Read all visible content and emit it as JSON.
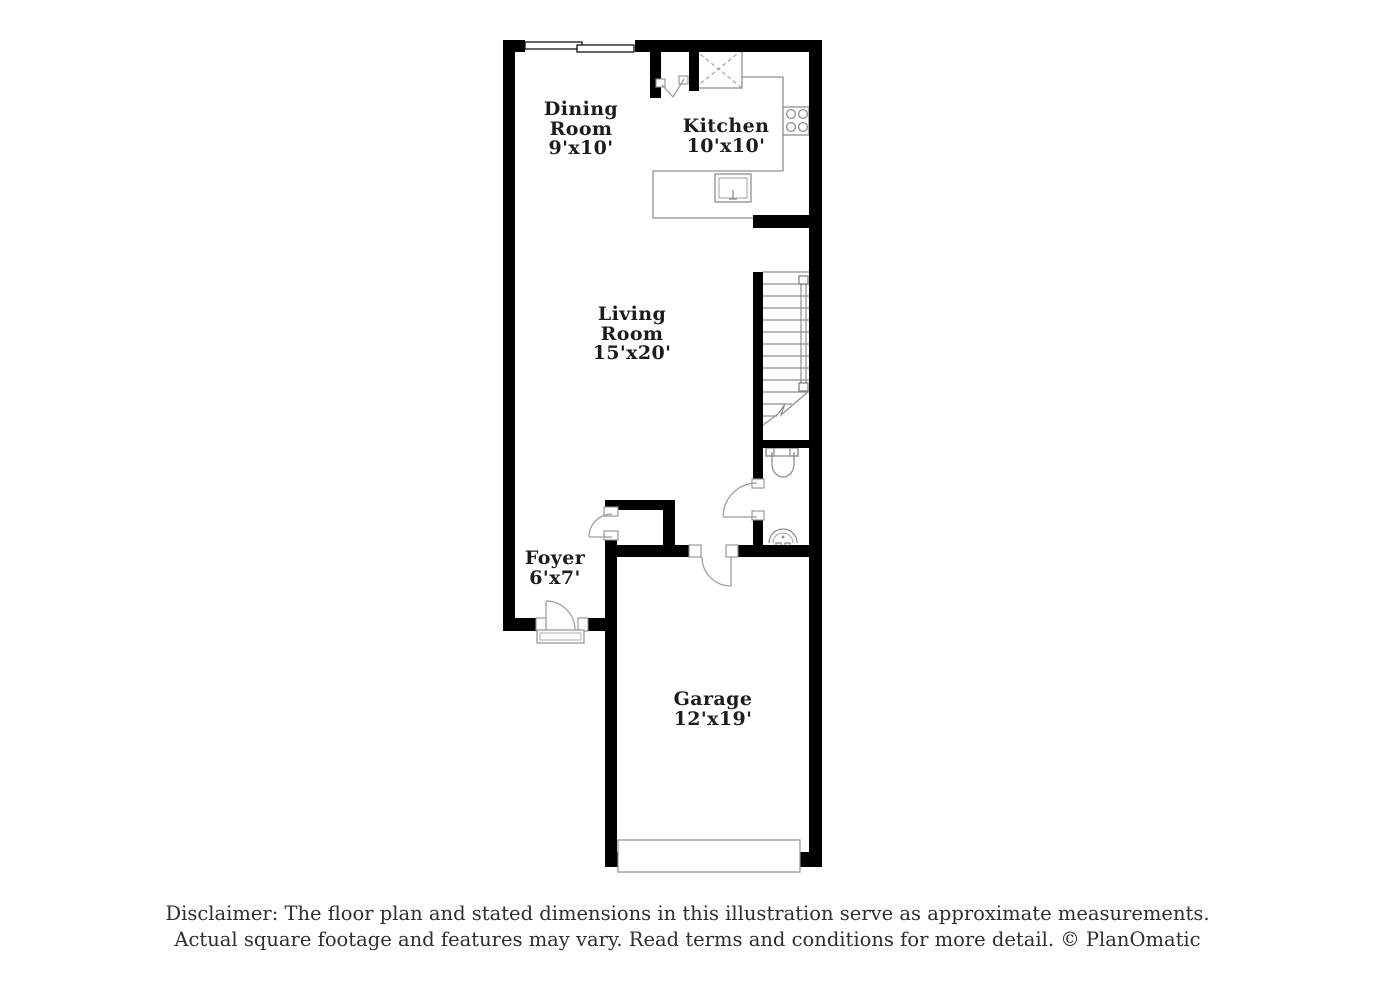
{
  "floorplan": {
    "rooms": {
      "dining": {
        "label": "Dining Room",
        "dims": "9'x10'"
      },
      "kitchen": {
        "label": "Kitchen",
        "dims": "10'x10'"
      },
      "living": {
        "label": "Living Room",
        "dims": "15'x20'"
      },
      "foyer": {
        "label": "Foyer",
        "dims": "6'x7'"
      },
      "garage": {
        "label": "Garage",
        "dims": "12'x19'"
      }
    },
    "fixtures": [
      "window",
      "refrigerator",
      "bifold-door",
      "stove",
      "kitchen-sink",
      "kitchen-counter",
      "staircase",
      "stair-railing",
      "toilet",
      "pedestal-sink",
      "powder-room-door",
      "closet-door",
      "garage-entry-door",
      "front-door",
      "door-threshold",
      "garage-door"
    ],
    "colors": {
      "wall": "#000000",
      "fixture_line": "#8f8f8f",
      "label_text": "#1c1c1c",
      "background": "#ffffff"
    }
  },
  "disclaimer": {
    "line1": "Disclaimer: The floor plan and stated dimensions in this illustration serve as approximate measurements.",
    "line2": "Actual square footage and features may vary. Read terms and conditions for more detail. © PlanOmatic"
  }
}
